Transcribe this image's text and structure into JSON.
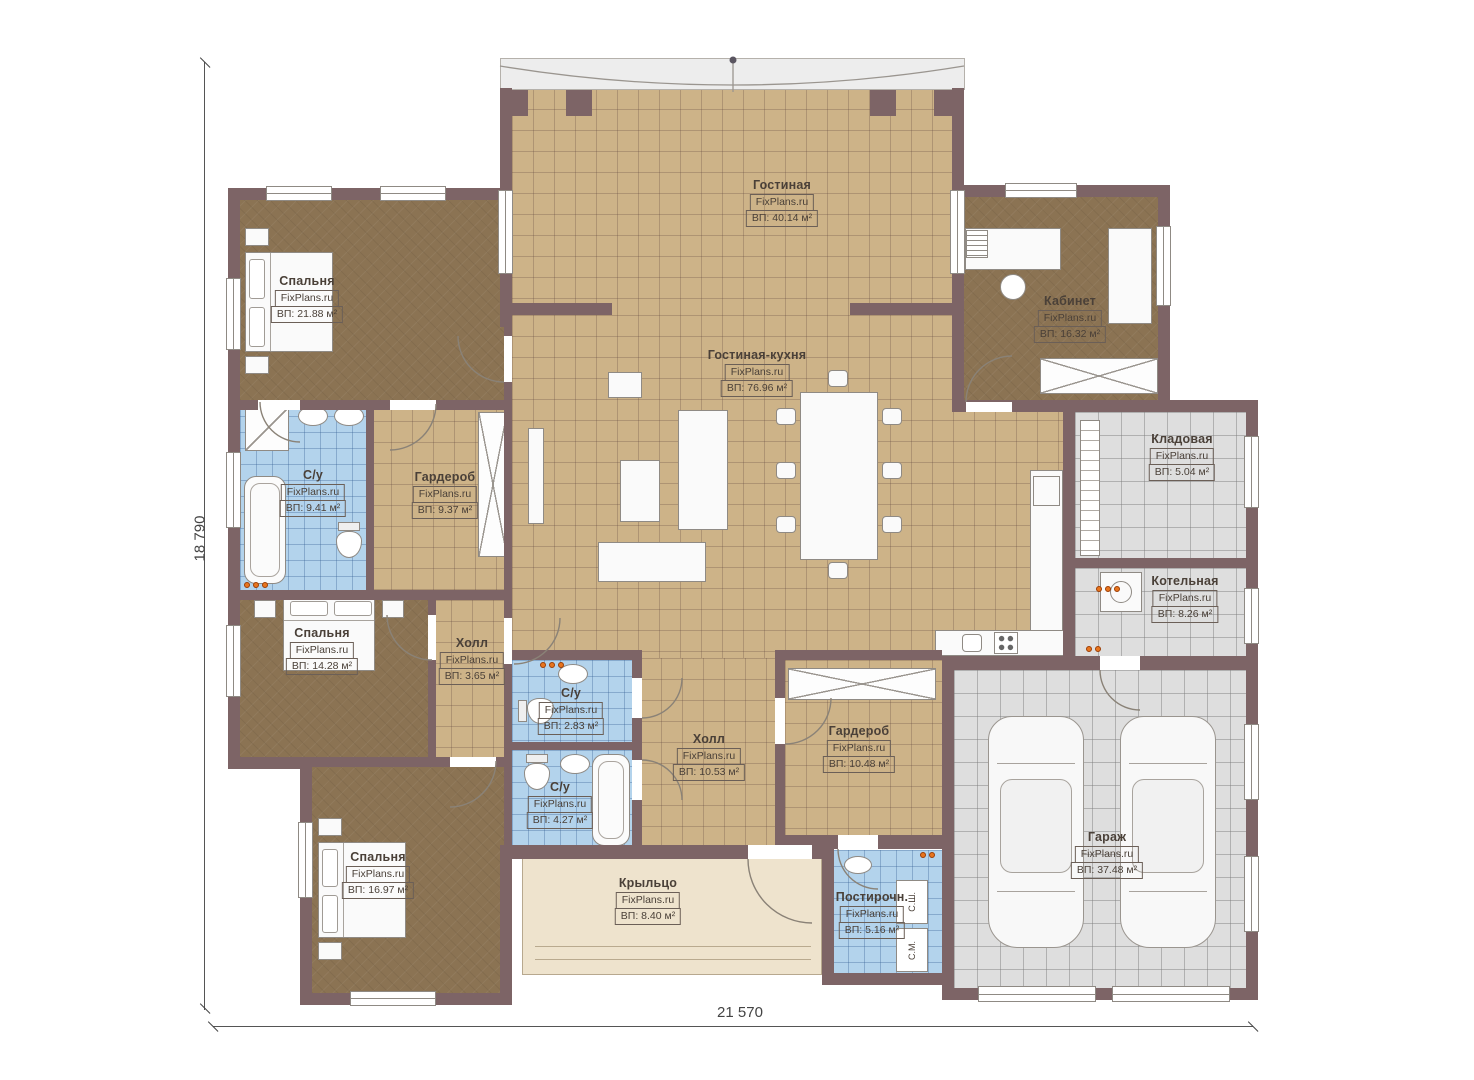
{
  "plan": {
    "watermark": "FixPlans.ru",
    "dimensions": {
      "left": "18 790",
      "bottom": "21 570"
    },
    "rooms": [
      {
        "name": "Гостиная",
        "area": "ВП: 40.14 м²"
      },
      {
        "name": "Спальня",
        "area": "ВП: 21.88 м²"
      },
      {
        "name": "Гостиная-кухня",
        "area": "ВП: 76.96 м²"
      },
      {
        "name": "Кабинет",
        "area": "ВП: 16.32 м²"
      },
      {
        "name": "С/у",
        "area": "ВП: 9.41 м²"
      },
      {
        "name": "Гардероб",
        "area": "ВП: 9.37 м²"
      },
      {
        "name": "Кладовая",
        "area": "ВП: 5.04 м²"
      },
      {
        "name": "Котельная",
        "area": "ВП: 8.26 м²"
      },
      {
        "name": "Спальня",
        "area": "ВП: 14.28 м²"
      },
      {
        "name": "Холл",
        "area": "ВП: 3.65 м²"
      },
      {
        "name": "С/у",
        "area": "ВП: 2.83 м²"
      },
      {
        "name": "Холл",
        "area": "ВП: 10.53 м²"
      },
      {
        "name": "Гардероб",
        "area": "ВП: 10.48 м²"
      },
      {
        "name": "С/у",
        "area": "ВП: 4.27 м²"
      },
      {
        "name": "Спальня",
        "area": "ВП: 16.97 м²"
      },
      {
        "name": "Крыльцо",
        "area": "ВП: 8.40 м²"
      },
      {
        "name": "Постирочн.",
        "area": "ВП: 5.16 м²"
      },
      {
        "name": "Гараж",
        "area": "ВП: 37.48 м²"
      }
    ],
    "appliances": {
      "dryer": "С.Ш.",
      "washer": "С.М."
    },
    "colors": {
      "wall": "#7d6466",
      "floor_beige": "#cdb388",
      "floor_brown": "#8b7353",
      "floor_blue": "#b3d3ec",
      "floor_gray": "#dedede",
      "accent_orange": "#e8751e"
    }
  }
}
